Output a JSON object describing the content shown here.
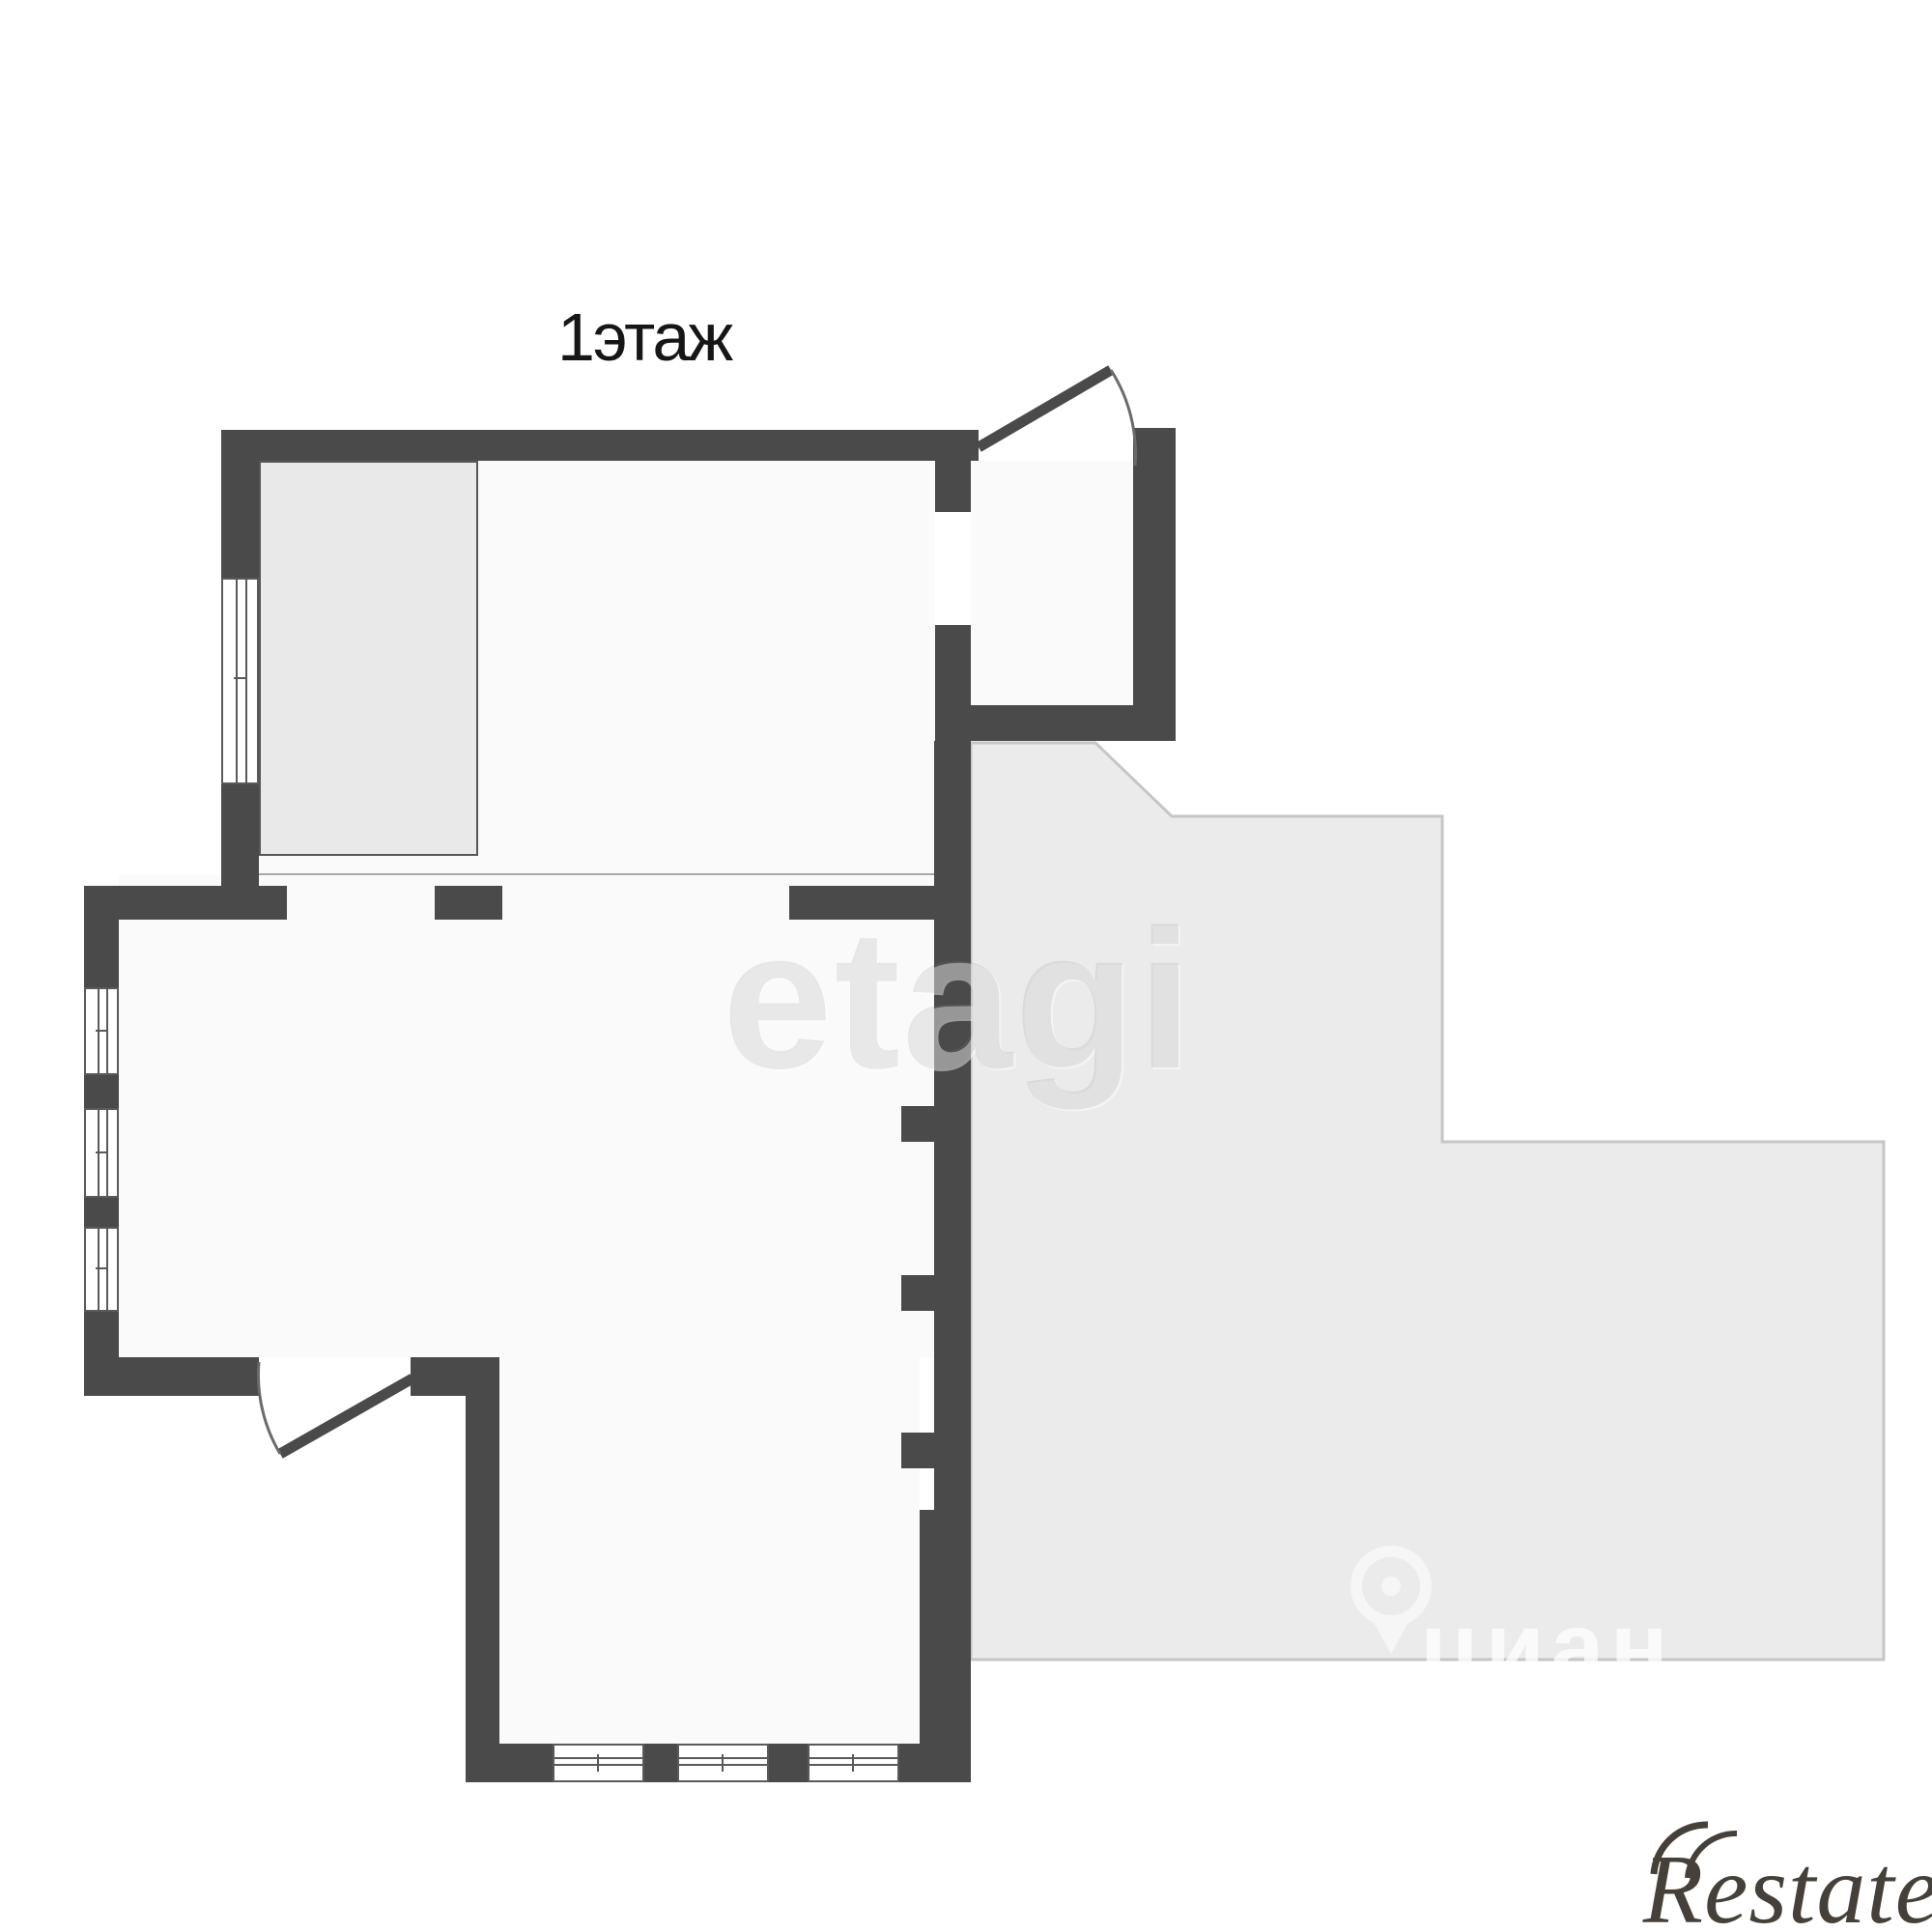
{
  "title": "1этаж",
  "rooms": [
    {
      "label": "помещение"
    },
    {
      "label": "помещение"
    }
  ],
  "watermarks": {
    "etagi": "etagi",
    "cian": "циан",
    "restate": "Restate"
  },
  "icons": [
    "location-pin-icon"
  ],
  "colors": {
    "wall": "#4a4a4a",
    "floor": "#fafafa",
    "closet_fill": "#e9e9e9",
    "adjacent_fill": "#ebebeb",
    "adjacent_border": "#c6c6c6",
    "title_text": "#161616",
    "label_text": "#333333",
    "etagi_watermark": "#e3e3e3",
    "restate_logo": "#45403a"
  }
}
